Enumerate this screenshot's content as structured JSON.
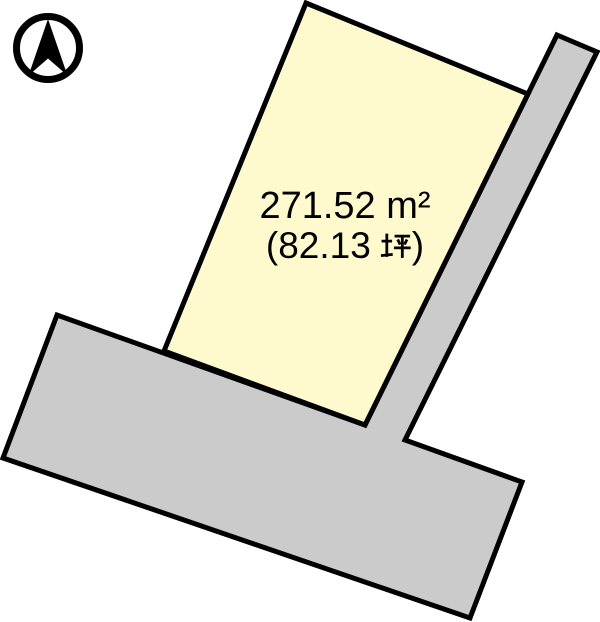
{
  "parcel": {
    "area_m2_display": "271.52 m²",
    "area_m2_full": "271.52 ㎡",
    "tsubo_open": "(",
    "tsubo_value": "82.13",
    "tsubo_unit": "坪",
    "tsubo_close": ")",
    "area_tsubo_full": "（82.13 坪）"
  },
  "icons": {
    "compass": "north-arrow-compass",
    "tsubo": "tsubo-kanji"
  },
  "colors": {
    "parcel_fill": "#FFFACD",
    "road_fill": "#CBCBCB",
    "outline": "#000000",
    "background": "#FFFFFF"
  }
}
